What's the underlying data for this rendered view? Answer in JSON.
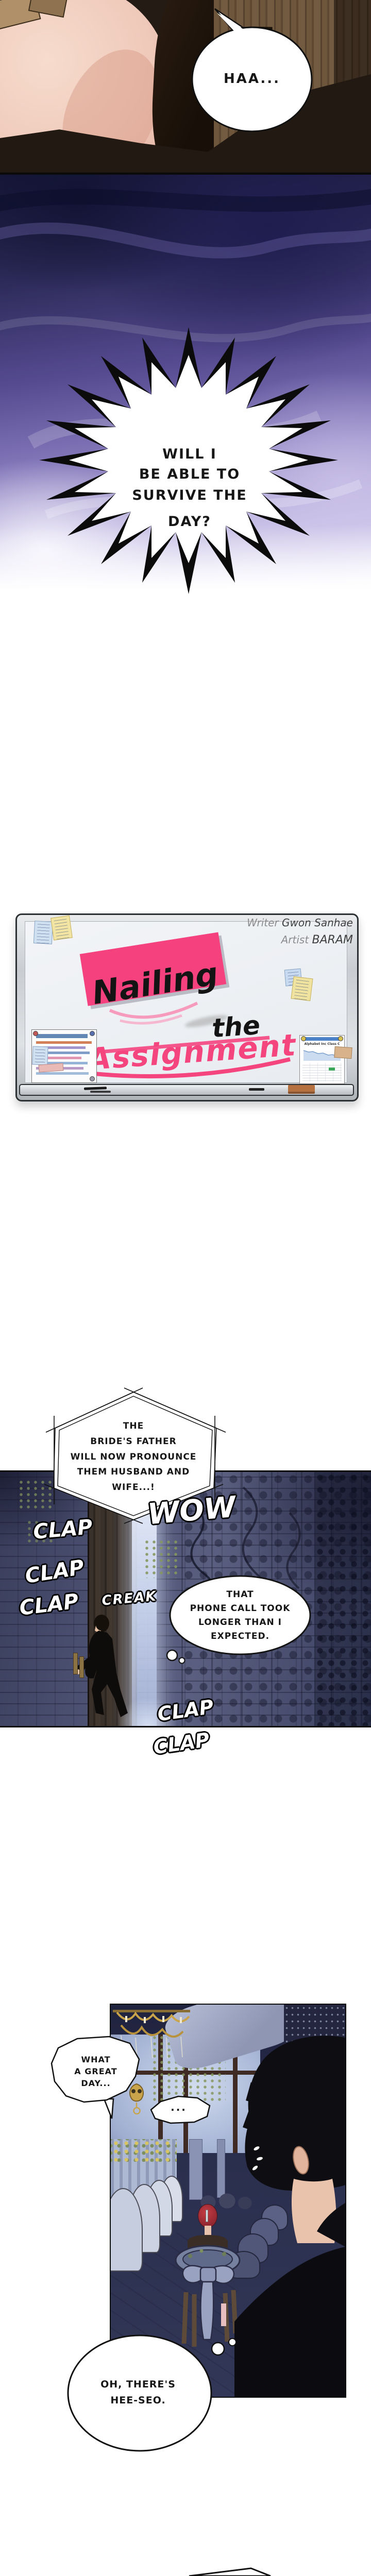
{
  "comic": {
    "panel1": {
      "haa": "HAA..."
    },
    "burst": {
      "lines": [
        "WILL I",
        "BE ABLE TO",
        "SURVIVE THE",
        "DAY?"
      ]
    },
    "board": {
      "writer_label": "Writer",
      "writer_name": "Gwon Sanhae",
      "artist_label": "Artist",
      "artist_name": "BARAM",
      "title_w1": "Nailing",
      "title_w2": "the",
      "title_w3": "Assignment",
      "chart_title": "Alphabet Inc Class C"
    },
    "wedding": {
      "caption": [
        "THE",
        "BRIDE'S FATHER",
        "WILL NOW PRONOUNCE",
        "THEM HUSBAND AND",
        "WIFE...!"
      ],
      "wow": "WOW",
      "clap1": "CLAP",
      "clap2": "CLAP",
      "clap3": "CLAP",
      "creak": "CREAK",
      "clap4": "CLAP",
      "clap5": "CLAP",
      "thought": [
        "THAT",
        "PHONE CALL TOOK",
        "LONGER THAN I",
        "EXPECTED."
      ]
    },
    "night": {
      "bubble1": [
        "WHAT",
        "A GREAT",
        "DAY..."
      ],
      "bubble2": "...",
      "bubble3": [
        "OH, THERE'S",
        "HEE-SEO."
      ]
    },
    "colors": {
      "accent_pink": "#f5437f",
      "purple_mid": "#5c4f96",
      "night_bg": "#2a2e4a"
    }
  }
}
